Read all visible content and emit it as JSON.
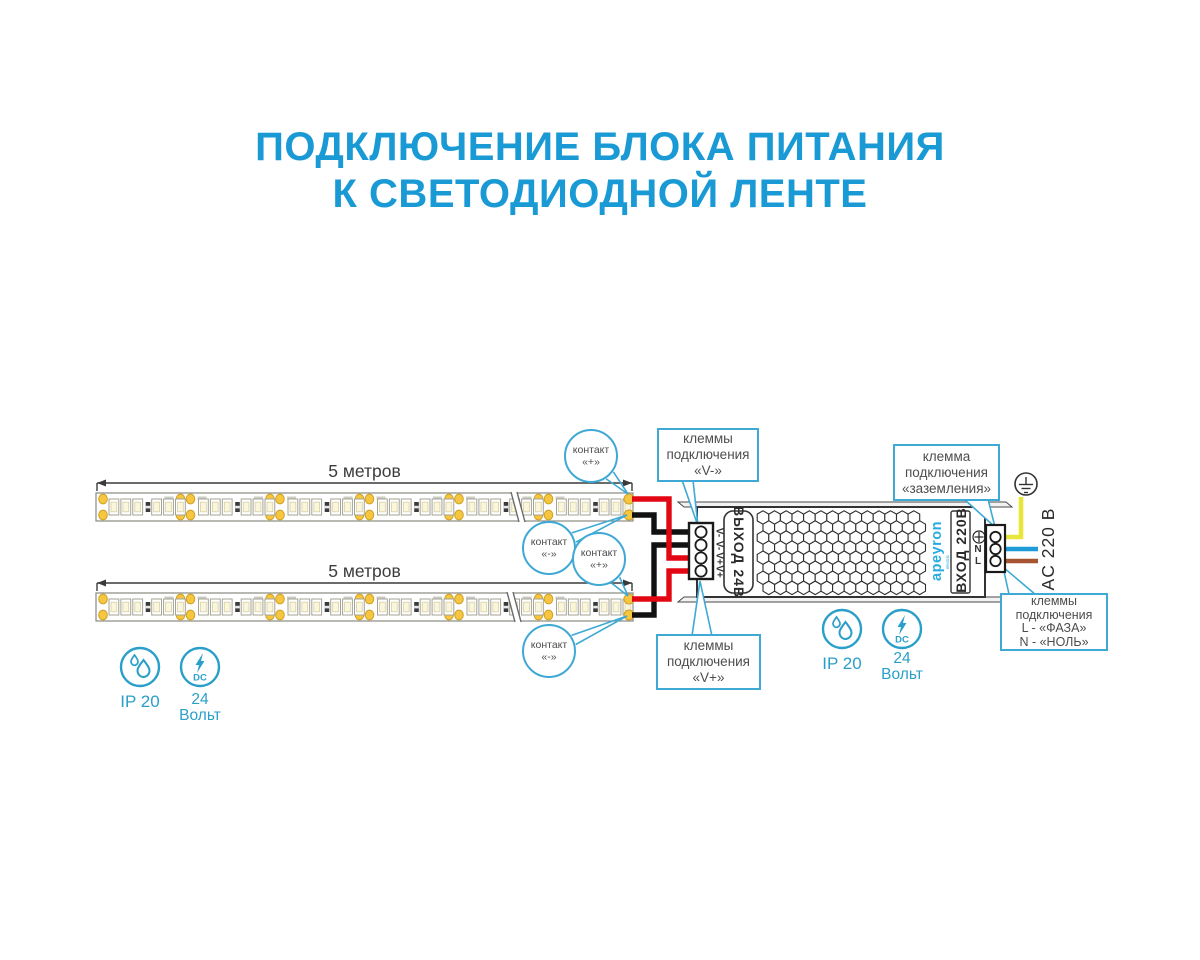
{
  "title": {
    "line1": "ПОДКЛЮЧЕНИЕ БЛОКА ПИТАНИЯ",
    "line2": "К СВЕТОДИОДНОЙ ЛЕНТЕ"
  },
  "strips": {
    "top_length": "5 метров",
    "bottom_length": "5 метров"
  },
  "contact_callouts": [
    {
      "line1": "контакт",
      "line2": "«+»"
    },
    {
      "line1": "контакт",
      "line2": "«-»"
    },
    {
      "line1": "контакт",
      "line2": "«+»"
    },
    {
      "line1": "контакт",
      "line2": "«-»"
    }
  ],
  "terminal_callouts": {
    "v_minus": {
      "line1": "клеммы",
      "line2": "подключения",
      "line3": "«V-»"
    },
    "v_plus": {
      "line1": "клеммы",
      "line2": "подключения",
      "line3": "«V+»"
    },
    "ground": {
      "line1": "клемма",
      "line2": "подключения",
      "line3": "«заземления»"
    },
    "mains": {
      "line1": "клеммы",
      "line2": "подключения",
      "line3": "L - «ФАЗА»",
      "line4": "N - «НОЛЬ»"
    }
  },
  "psu": {
    "output_label": "ВЫХОД 24В",
    "input_label": "ВХОД 220В",
    "brand": "apeyron",
    "brand_sub": "electric",
    "output_terminals": [
      "V-",
      "V-",
      "V+",
      "V+"
    ],
    "input_terminal_n": "N",
    "input_terminal_l": "L"
  },
  "ac_voltage_label": "AC 220 В",
  "badges": {
    "ip": "IP 20",
    "dc_line1": "24",
    "dc_line2": "Вольт",
    "dc_icon_text": "DC"
  },
  "colors": {
    "title_blue": "#1a9ad5",
    "callout_blue": "#3fa9d6",
    "accent_teal": "#2a9fc9",
    "brand_blue": "#29abe2",
    "wire_red": "#e30613",
    "wire_black": "#111111",
    "wire_yellow": "#e9e63b",
    "wire_blue": "#1e9cd8",
    "wire_brown": "#a85432",
    "pad_gold": "#f5c63e"
  }
}
